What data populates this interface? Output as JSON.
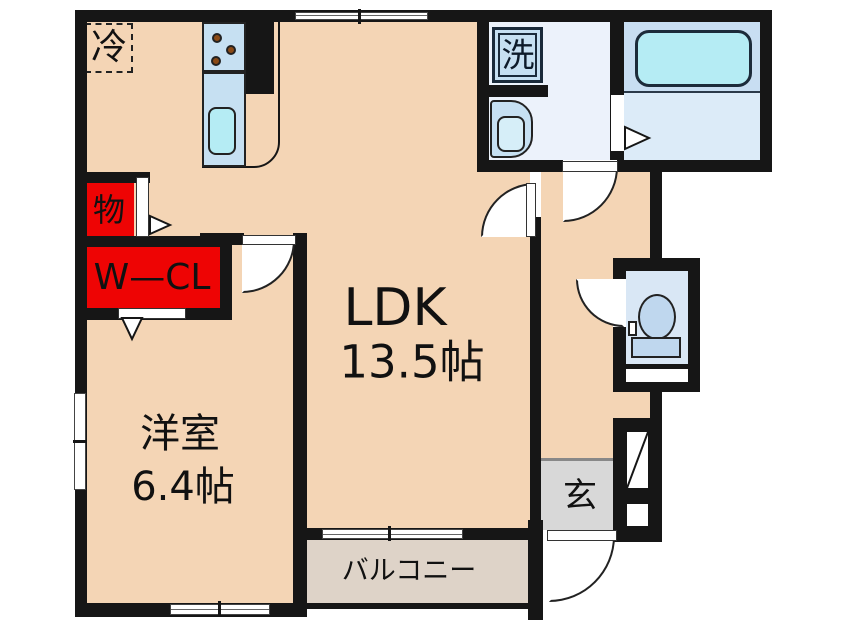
{
  "rooms": {
    "ldk": {
      "name": "LDK",
      "size": "13.5帖"
    },
    "bedroom": {
      "name": "洋室",
      "size": "6.4帖"
    },
    "balcony": {
      "label": "バルコニー"
    },
    "entrance": {
      "label": "玄"
    }
  },
  "fixtures": {
    "refrigerator": "冷",
    "washing_machine": "洗",
    "storage": "物",
    "walk_in_closet": "W—CL"
  },
  "colors": {
    "wall": "#161616",
    "floor": "#f4d5b5",
    "balcony-floor": "#ded3c8",
    "entrance-floor": "#d8d8d8",
    "closet-red": "#ee0404",
    "fixture-blue": "#c6e0f2",
    "water-cyan": "#b5ecf4",
    "bath-floor": "#c8def2",
    "bath-floor-lower": "#dcebf8",
    "washroom-floor": "#ecf2fb",
    "toilet-floor": "#d9e7f5",
    "toilet-fixture": "#bfd7ee",
    "burner": "#8a4a16"
  }
}
